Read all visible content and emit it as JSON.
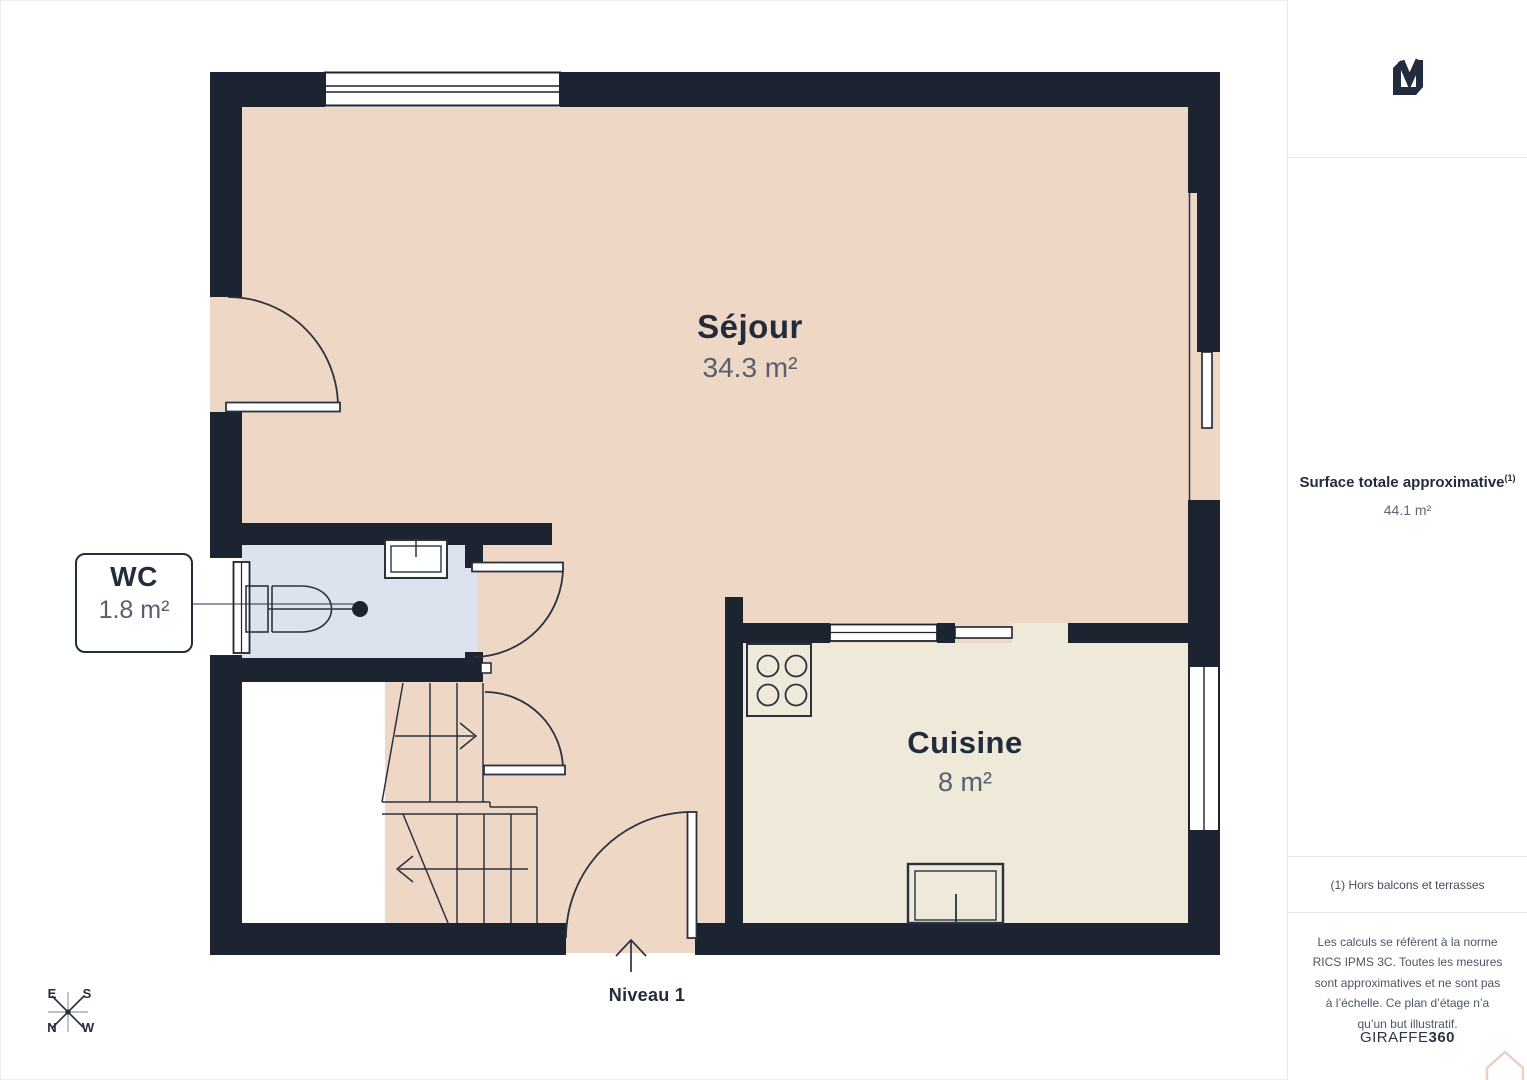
{
  "plan": {
    "level_label": "Niveau 1",
    "rooms": [
      {
        "name": "Séjour",
        "area": "34.3 m²"
      },
      {
        "name": "Cuisine",
        "area": "8 m²"
      },
      {
        "name": "WC",
        "area": "1.8 m²"
      }
    ],
    "compass": {
      "top_left": "E",
      "top_right": "S",
      "bottom_left": "N",
      "bottom_right": "W"
    }
  },
  "sidebar": {
    "logo_monogram": "LM",
    "surface_title": "Surface totale approximative",
    "surface_footnote_marker": "(1)",
    "surface_value": "44.1 m²",
    "footnote": "(1) Hors balcons et terrasses",
    "disclaimer": "Les calculs se réfèrent à la norme RICS IPMS 3C. Toutes les mesures sont approximatives et ne sont pas à l’échelle. Ce plan d’étage n’a qu’un but illustratif.",
    "brand": {
      "name": "GIRAFFE",
      "suffix": "360"
    }
  },
  "colors": {
    "wall": "#1b2430",
    "line": "#2a3242",
    "floor_sejour": "#efd7c6",
    "floor_cuisine": "#eee9d8",
    "floor_wc": "#dce3ef",
    "text_dark": "#232c3c",
    "text_grey": "#57606f",
    "divider": "#e6e8eb",
    "house_watermark": "#f0cdc3"
  }
}
